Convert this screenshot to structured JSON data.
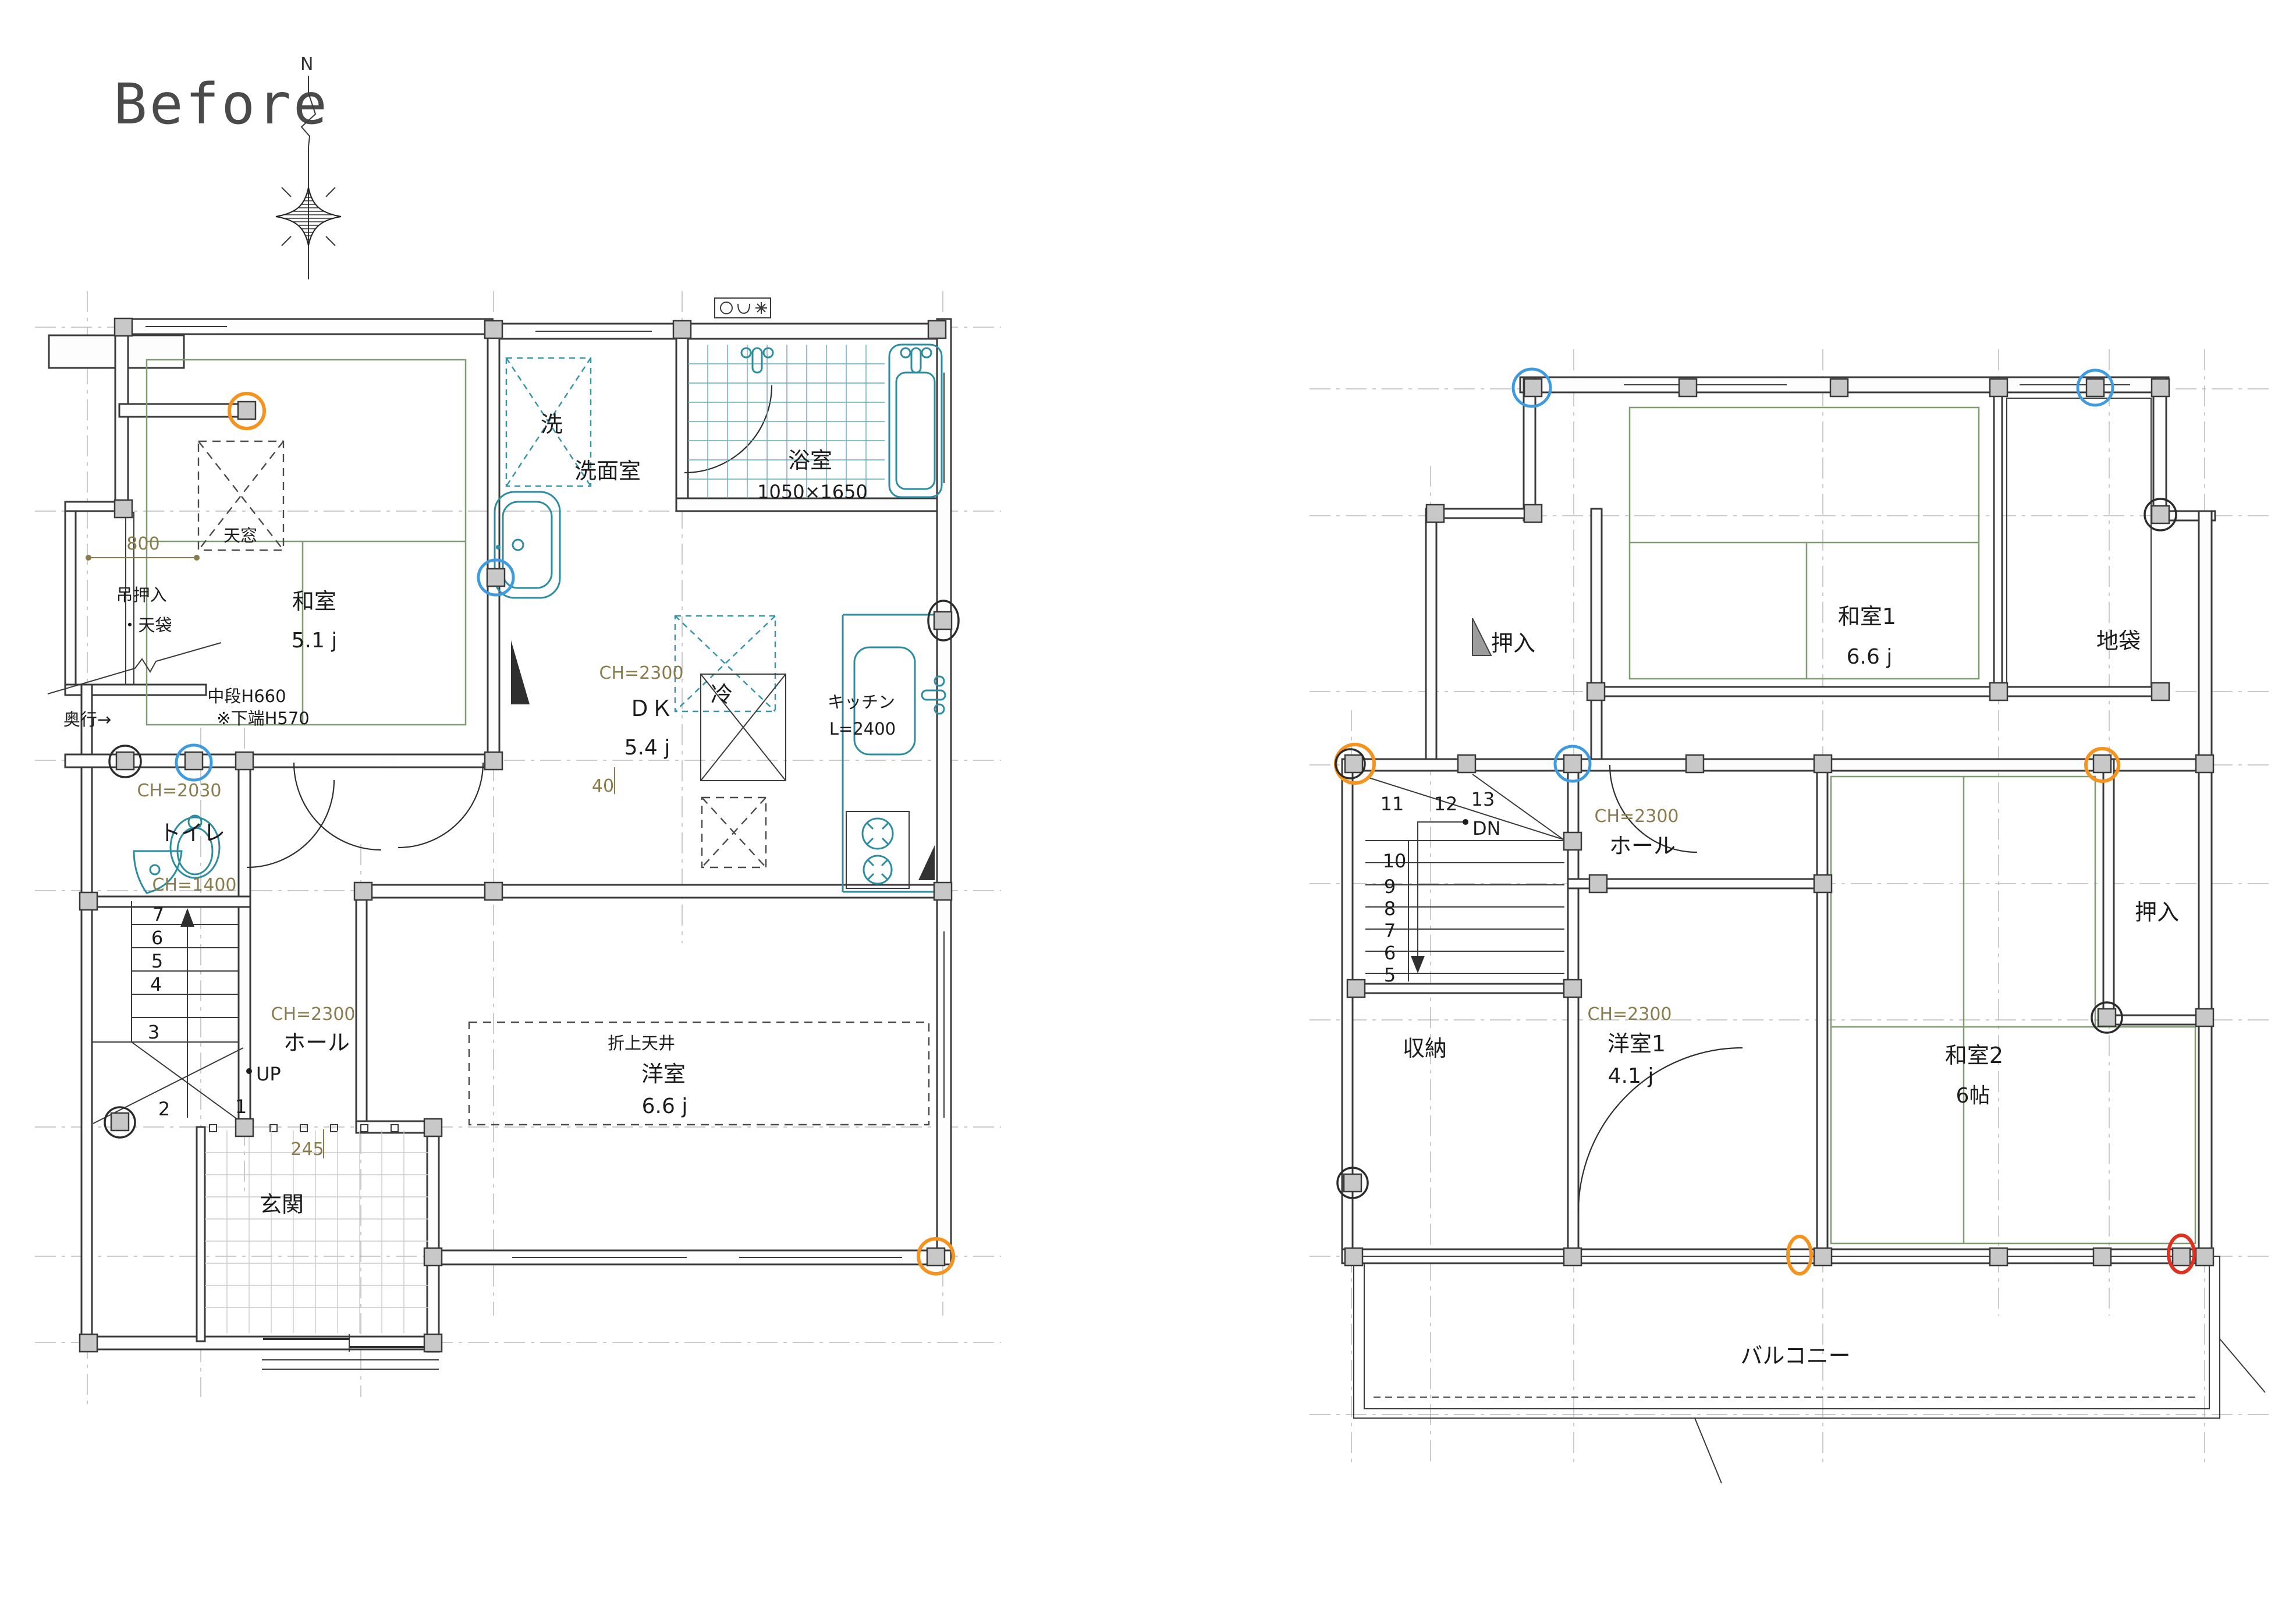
{
  "title": "Before",
  "compass": {
    "north": "N"
  },
  "colors": {
    "annotation_orange": "#f6921e",
    "annotation_blue": "#3f9be0",
    "annotation_red": "#e03020",
    "tatami_green": "#7e9c70",
    "plumbing_teal": "#2c8da0",
    "dimension_olive": "#8b7c4d"
  },
  "floor1": {
    "washitsu": {
      "name": "和室",
      "area": "5.1 j"
    },
    "tenmado": "天窓",
    "dim_800": "800",
    "tsuri_oshiire": "吊押入",
    "tenbukuro": "・天袋",
    "okuyuki": "奥行→",
    "chudan": "中段H660",
    "shitaba": "※下端H570",
    "ch_2030": "CH=2030",
    "toilet": "トイレ",
    "ch_1400": "CH=1400",
    "sen": "洗",
    "senmenshitsu": "洗面室",
    "yokushitsu": {
      "name": "浴室",
      "size": "1050×1650"
    },
    "rei": "冷",
    "dk": {
      "ch": "CH=2300",
      "name": "ＤＫ",
      "area": "5.4 j"
    },
    "kitchen": {
      "name": "キッチン",
      "length": "L=2400"
    },
    "dim_40": "40",
    "hall": {
      "ch": "CH=2300",
      "name": "ホール"
    },
    "up": "UP",
    "stairs": [
      "7",
      "6",
      "5",
      "4",
      "3",
      "2",
      "1"
    ],
    "dim_245": "245",
    "genkan": "玄関",
    "yoshitsu": {
      "ceiling": "折上天井",
      "name": "洋室",
      "area": "6.6 j"
    }
  },
  "floor2": {
    "oshiire_left": "押入",
    "washitsu1": {
      "name": "和室1",
      "area": "6.6 j"
    },
    "jibukuro": "地袋",
    "stairs_top": [
      "11",
      "12",
      "13"
    ],
    "dn": "DN",
    "stairs_run": [
      "10",
      "9",
      "8",
      "7",
      "6",
      "5"
    ],
    "hall": {
      "ch": "CH=2300",
      "name": "ホール"
    },
    "shuno": "収納",
    "yoshitsu1": {
      "ch": "CH=2300",
      "name": "洋室1",
      "area": "4.1 j"
    },
    "washitsu2": {
      "name": "和室2",
      "area": "6帖"
    },
    "oshiire_right": "押入",
    "balcony": "バルコニー"
  }
}
